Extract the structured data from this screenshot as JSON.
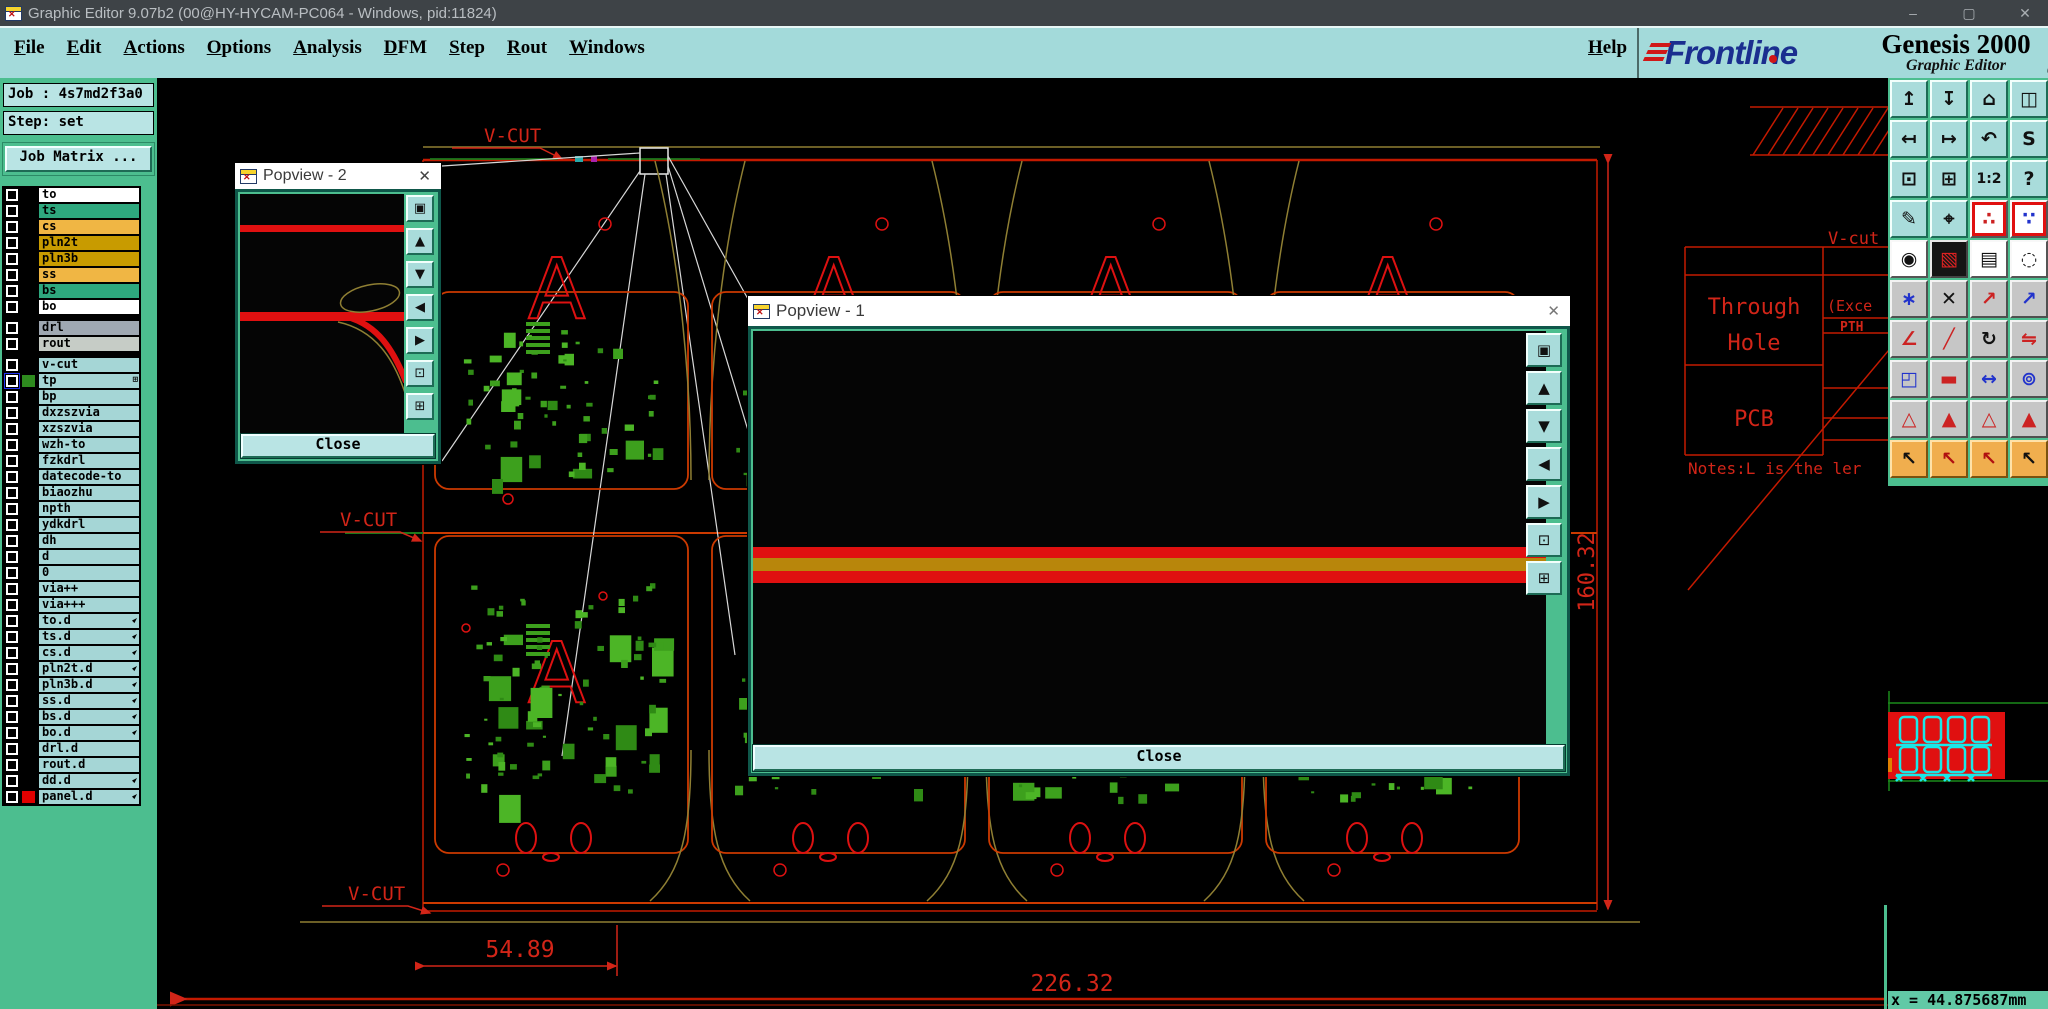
{
  "window": {
    "title": "Graphic Editor 9.07b2 (00@HY-HYCAM-PC064 - Windows, pid:11824)",
    "minimize": "–",
    "maximize": "▢",
    "close": "✕"
  },
  "menu": {
    "items": [
      "File",
      "Edit",
      "Actions",
      "Options",
      "Analysis",
      "DFM",
      "Step",
      "Rout",
      "Windows"
    ],
    "help": "Help"
  },
  "brand": {
    "logo": "Frontline",
    "product": "Genesis 2000",
    "subtitle": "Graphic Editor",
    "date": "06 Nov 2024",
    "time": "08:35 AM"
  },
  "job_panel": {
    "job_label": "Job : 4s7md2f3a0",
    "step_label": "Step: set",
    "matrix_button": "Job Matrix ..."
  },
  "layers": {
    "rows": [
      {
        "name": "to",
        "bg": "#FFFFFF"
      },
      {
        "name": "ts",
        "bg": "#2EA87E"
      },
      {
        "name": "cs",
        "bg": "#F0B644"
      },
      {
        "name": "pln2t",
        "bg": "#C89B00"
      },
      {
        "name": "pln3b",
        "bg": "#C89B00"
      },
      {
        "name": "ss",
        "bg": "#F0B644"
      },
      {
        "name": "bs",
        "bg": "#2EA87E"
      },
      {
        "name": "bo",
        "bg": "#FFFFFF"
      },
      {
        "name": "drl",
        "bg": "#9FA8B2",
        "sep": true
      },
      {
        "name": "rout",
        "bg": "#C6CCC6"
      },
      {
        "name": "v-cut",
        "bg": "#A5D6D6",
        "sep": true
      },
      {
        "name": "tp",
        "bg": "#A5D6D6",
        "selected": true,
        "swatch": "#2E8B1E",
        "icon": "grid"
      },
      {
        "name": "bp",
        "bg": "#A5D6D6"
      },
      {
        "name": "dxzszvia",
        "bg": "#A5D6D6"
      },
      {
        "name": "xzszvia",
        "bg": "#A5D6D6"
      },
      {
        "name": "wzh-to",
        "bg": "#A5D6D6"
      },
      {
        "name": "fzkdrl",
        "bg": "#A5D6D6"
      },
      {
        "name": "datecode-to",
        "bg": "#A5D6D6"
      },
      {
        "name": "biaozhu",
        "bg": "#A5D6D6"
      },
      {
        "name": "npth",
        "bg": "#A5D6D6"
      },
      {
        "name": "ydkdrl",
        "bg": "#A5D6D6"
      },
      {
        "name": "dh",
        "bg": "#A5D6D6"
      },
      {
        "name": "d",
        "bg": "#A5D6D6"
      },
      {
        "name": "0",
        "bg": "#A5D6D6"
      },
      {
        "name": "via++",
        "bg": "#A5D6D6"
      },
      {
        "name": "via+++",
        "bg": "#A5D6D6"
      },
      {
        "name": "to.d",
        "bg": "#A5D6D6",
        "icon": "hand"
      },
      {
        "name": "ts.d",
        "bg": "#A5D6D6",
        "icon": "hand"
      },
      {
        "name": "cs.d",
        "bg": "#A5D6D6",
        "icon": "hand"
      },
      {
        "name": "pln2t.d",
        "bg": "#A5D6D6",
        "icon": "hand"
      },
      {
        "name": "pln3b.d",
        "bg": "#A5D6D6",
        "icon": "hand"
      },
      {
        "name": "ss.d",
        "bg": "#A5D6D6",
        "icon": "hand"
      },
      {
        "name": "bs.d",
        "bg": "#A5D6D6",
        "icon": "hand"
      },
      {
        "name": "bo.d",
        "bg": "#A5D6D6",
        "icon": "hand"
      },
      {
        "name": "drl.d",
        "bg": "#A5D6D6"
      },
      {
        "name": "rout.d",
        "bg": "#A5D6D6"
      },
      {
        "name": "dd.d",
        "bg": "#A5D6D6",
        "icon": "hand"
      },
      {
        "name": "panel.d",
        "bg": "#A5D6D6",
        "swatch": "#E00000",
        "icon": "hand"
      }
    ]
  },
  "popview2": {
    "title": "Popview - 2",
    "close_label": "Close"
  },
  "popview1": {
    "title": "Popview - 1",
    "close_label": "Close"
  },
  "popview_toolbar": [
    {
      "name": "open-view",
      "glyph": "▣"
    },
    {
      "name": "pan-up",
      "glyph": "▲"
    },
    {
      "name": "pan-down",
      "glyph": "▼"
    },
    {
      "name": "pan-left",
      "glyph": "◀"
    },
    {
      "name": "pan-right",
      "glyph": "▶"
    },
    {
      "name": "fit-view",
      "glyph": "⊡"
    },
    {
      "name": "center-view",
      "glyph": "⊞"
    }
  ],
  "right_toolbar": {
    "buttons": [
      {
        "name": "view-zoom-in",
        "glyph": "↥",
        "bg": "teal"
      },
      {
        "name": "view-zoom-out",
        "glyph": "↧",
        "bg": "teal"
      },
      {
        "name": "home-view",
        "glyph": "⌂",
        "bg": "teal"
      },
      {
        "name": "split-window-xy",
        "glyph": "◫",
        "bg": "teal"
      },
      {
        "name": "pan-view-left",
        "glyph": "↤",
        "bg": "teal"
      },
      {
        "name": "pan-view-right",
        "glyph": "↦",
        "bg": "teal"
      },
      {
        "name": "previous-view",
        "glyph": "↶",
        "bg": "teal"
      },
      {
        "name": "serpentine-view",
        "glyph": "S",
        "bg": "teal"
      },
      {
        "name": "fit-window",
        "glyph": "⊡",
        "bg": "teal"
      },
      {
        "name": "center-view",
        "glyph": "⊞",
        "bg": "teal"
      },
      {
        "name": "scale-1-2",
        "glyph": "1:2",
        "bg": "teal"
      },
      {
        "name": "query-help",
        "glyph": "?",
        "bg": "teal"
      },
      {
        "name": "edit-tools",
        "glyph": "✎",
        "bg": "teal"
      },
      {
        "name": "snap-target",
        "glyph": "⌖",
        "bg": "teal"
      },
      {
        "name": "net-highlight-a",
        "glyph": "∴",
        "bg": "white",
        "fg": "#CC2222",
        "frame": true
      },
      {
        "name": "net-highlight-b",
        "glyph": "∵",
        "bg": "white",
        "fg": "#2233CC",
        "frame": true
      },
      {
        "name": "move-object",
        "glyph": "◉",
        "bg": "white"
      },
      {
        "name": "shape-edit",
        "glyph": "▧",
        "bg": "black",
        "fg": "#DD2222"
      },
      {
        "name": "ruler-measure",
        "glyph": "▤",
        "bg": "white"
      },
      {
        "name": "select-circle",
        "glyph": "◌",
        "bg": "white"
      },
      {
        "name": "chain-select",
        "glyph": "∗",
        "bg": "gray",
        "fg": "#2233CC"
      },
      {
        "name": "delete-object",
        "glyph": "✕",
        "bg": "gray"
      },
      {
        "name": "measure-point",
        "glyph": "↗",
        "bg": "gray",
        "fg": "#CC2222"
      },
      {
        "name": "measure-point-2",
        "glyph": "↗",
        "bg": "gray",
        "fg": "#2233CC"
      },
      {
        "name": "measure-angle",
        "glyph": "∠",
        "bg": "gray",
        "fg": "#CC2222"
      },
      {
        "name": "measure-slope",
        "glyph": "╱",
        "bg": "gray",
        "fg": "#CC2222"
      },
      {
        "name": "rotate-object",
        "glyph": "↻",
        "bg": "gray"
      },
      {
        "name": "mirror-object",
        "glyph": "⇋",
        "bg": "gray",
        "fg": "#CC2222"
      },
      {
        "name": "copy-other-layer",
        "glyph": "◰",
        "bg": "gray",
        "fg": "#2233CC"
      },
      {
        "name": "stretch-line",
        "glyph": "▬",
        "bg": "gray",
        "fg": "#CC2222"
      },
      {
        "name": "measure-distance",
        "glyph": "↔",
        "bg": "gray",
        "fg": "#2233CC"
      },
      {
        "name": "group-circles",
        "glyph": "⊚",
        "bg": "gray",
        "fg": "#2233CC"
      },
      {
        "name": "marker-style-1",
        "glyph": "△",
        "bg": "gray",
        "fg": "#CC2222"
      },
      {
        "name": "marker-style-2",
        "glyph": "▲",
        "bg": "gray",
        "fg": "#CC2222"
      },
      {
        "name": "marker-style-3",
        "glyph": "△",
        "bg": "gray",
        "fg": "#CC2222"
      },
      {
        "name": "marker-style-4",
        "glyph": "▲",
        "bg": "gray",
        "fg": "#CC2222"
      },
      {
        "name": "select-single",
        "glyph": "↖",
        "bg": "orange"
      },
      {
        "name": "select-frame",
        "glyph": "↖",
        "bg": "orange",
        "fg": "#B01010"
      },
      {
        "name": "select-polygon",
        "glyph": "↖",
        "bg": "orange",
        "fg": "#B01010"
      },
      {
        "name": "select-net",
        "glyph": "↖",
        "bg": "orange"
      }
    ]
  },
  "canvas_text": {
    "vcut_top": "V-CUT",
    "vcut_mid": "V-CUT",
    "vcut_bottom": "V-CUT",
    "vcut_right": "V-cut",
    "dim_part": "54.89",
    "dim_total": "226.32",
    "dim_height": "160.32",
    "table_row1a": "Through",
    "table_row1b": "Hole",
    "table_row2": "PCB",
    "table_exc": "(Exce",
    "table_pth": "PTH",
    "note": "Notes:L is the ler",
    "marker_letter": "A"
  },
  "status": {
    "x_readout": "x = 44.875687mm"
  },
  "colors": {
    "accent_teal": "#4CBE8F",
    "panel_cyan": "#A3DADA",
    "cad_red": "#D22518",
    "board_orange": "#CC3A00",
    "vcut_olive": "#8F7F33",
    "pcb_green": "#3DA01D",
    "stripe_gold": "#B8860B"
  }
}
